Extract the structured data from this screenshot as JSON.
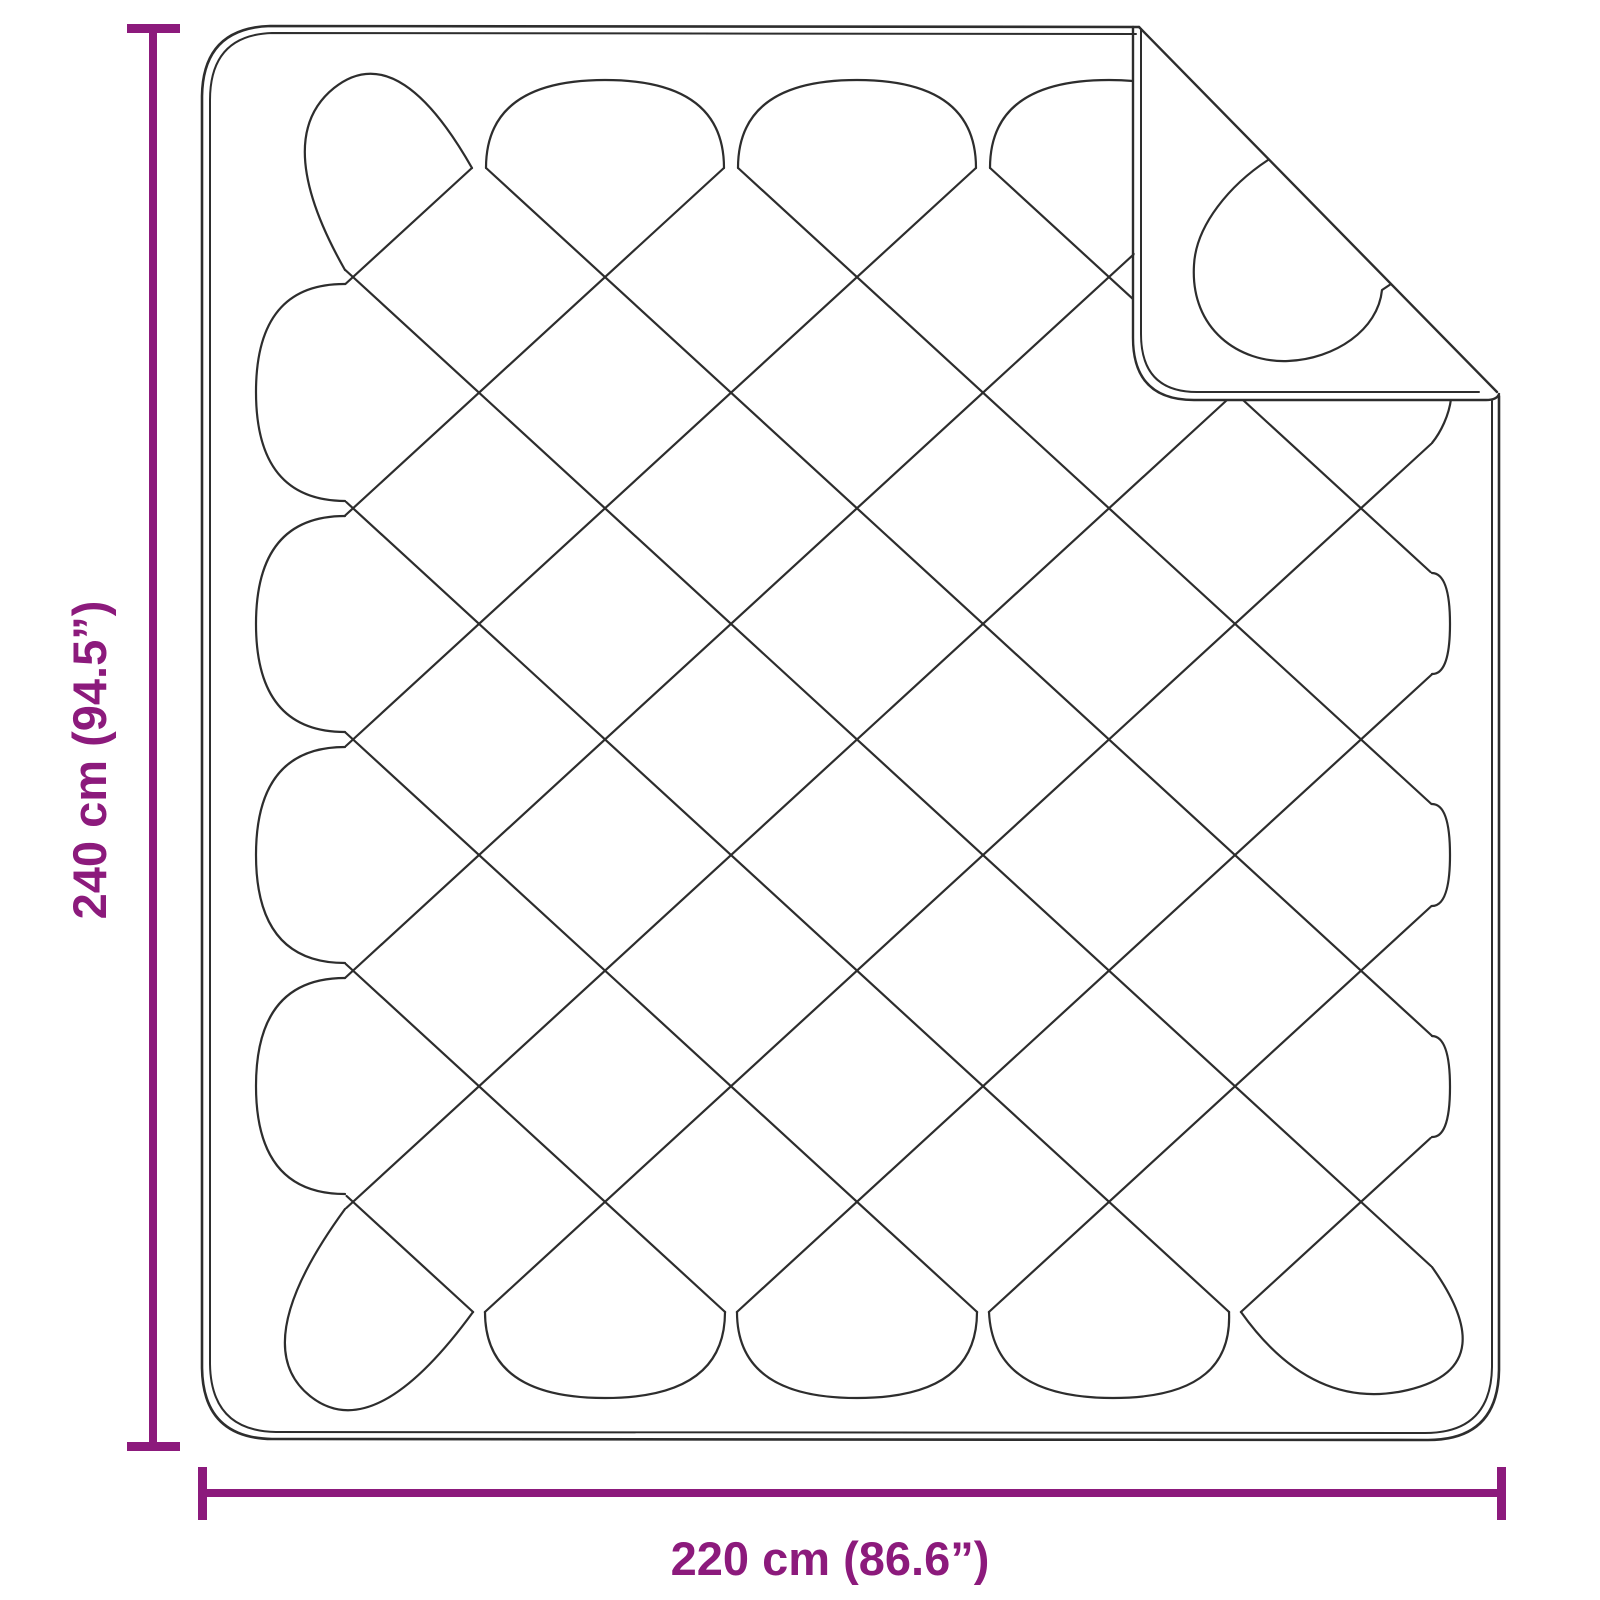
{
  "diagram": {
    "type": "product-dimension-line-drawing",
    "subject": "quilted-blanket-with-folded-corner",
    "dimension_height": {
      "label": "240 cm (94.5”)"
    },
    "dimension_width": {
      "label": "220 cm (86.6”)"
    },
    "colors": {
      "accent": "#8c1a7c",
      "line": "#2d2d2d",
      "background": "#ffffff"
    }
  }
}
